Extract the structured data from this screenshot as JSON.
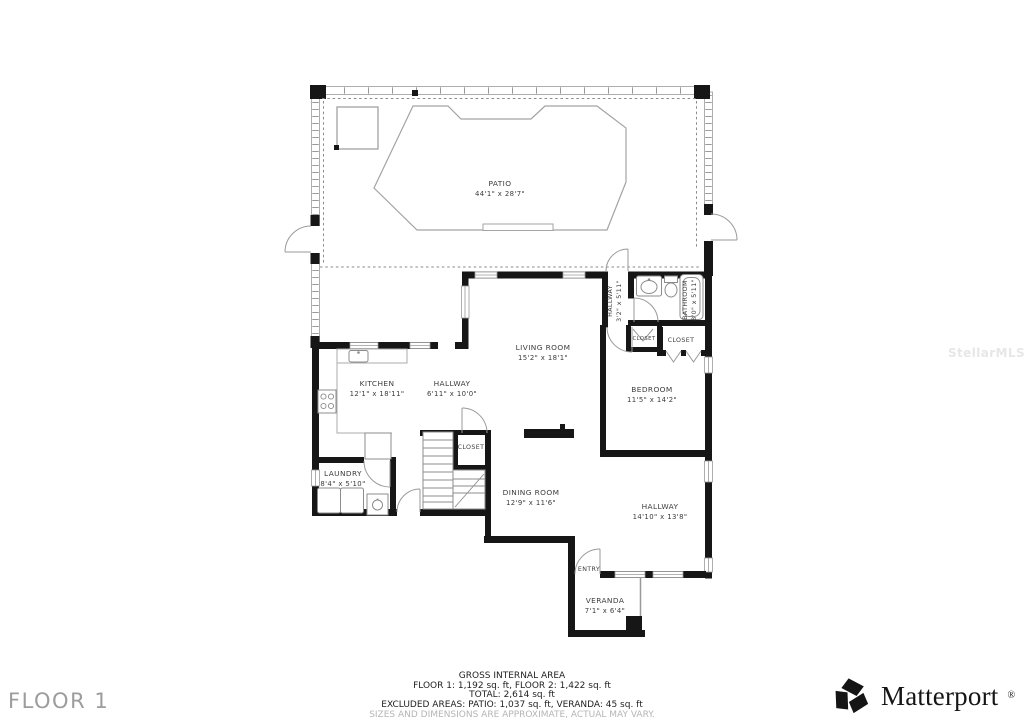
{
  "floor_label": "FLOOR 1",
  "watermark": "StellarMLS",
  "rooms": {
    "patio": {
      "name": "PATIO",
      "dims": "44'1\" x 28'7\""
    },
    "living": {
      "name": "LIVING ROOM",
      "dims": "15'2\" x 18'1\""
    },
    "kitchen": {
      "name": "KITCHEN",
      "dims": "12'1\" x 18'11\""
    },
    "hallway_main": {
      "name": "HALLWAY",
      "dims": "6'11\" x 10'0\""
    },
    "hallway_small": {
      "name": "HALLWAY",
      "dims": "3'2\" x 5'11\""
    },
    "bathroom": {
      "name": "BATHROOM",
      "dims": "8'0\" x 5'11\""
    },
    "closet_small": {
      "name": "CLOSET"
    },
    "closet_large": {
      "name": "CLOSET"
    },
    "bedroom": {
      "name": "BEDROOM",
      "dims": "11'5\" x 14'2\""
    },
    "laundry": {
      "name": "LAUNDRY",
      "dims": "8'4\" x 5'10\""
    },
    "closet_stairs": {
      "name": "CLOSET"
    },
    "dining": {
      "name": "DINING ROOM",
      "dims": "12'9\" x 11'6\""
    },
    "hallway_entry": {
      "name": "HALLWAY",
      "dims": "14'10\" x 13'8\""
    },
    "entry": {
      "name": "ENTRY"
    },
    "veranda": {
      "name": "VERANDA",
      "dims": "7'1\" x 6'4\""
    }
  },
  "footer": {
    "heading": "GROSS INTERNAL AREA",
    "floors": "FLOOR 1: 1,192 sq. ft, FLOOR 2: 1,422 sq. ft",
    "total": "TOTAL: 2,614 sq. ft",
    "excluded": "EXCLUDED AREAS: PATIO: 1,037 sq. ft, VERANDA: 45 sq. ft",
    "disclaimer": "SIZES AND DIMENSIONS ARE APPROXIMATE, ACTUAL MAY VARY."
  },
  "brand": {
    "name": "Matterport",
    "registered": "®"
  },
  "colors": {
    "wall": "#161616",
    "thin_line": "#9a9a9a",
    "room_label": "#3c3c3c",
    "floor_label": "#9c9c9c",
    "footer_text": "#1f1f1f",
    "disclaimer": "#b5b5b5",
    "watermark": "#e7e7e7",
    "background": "#ffffff"
  }
}
